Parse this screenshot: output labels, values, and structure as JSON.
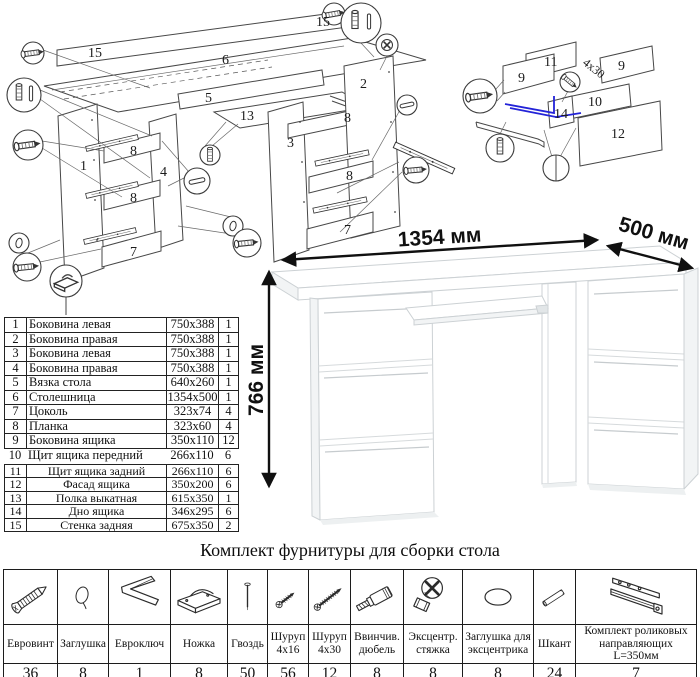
{
  "colors": {
    "accent_blue": "#2323d8",
    "diagram_line": "#474747",
    "desk_edge": "#ccd1d4"
  },
  "main_diagram": {
    "part_labels": [
      "15",
      "6",
      "15",
      "1",
      "8",
      "4",
      "8",
      "7",
      "5",
      "13",
      "3",
      "2",
      "8",
      "8",
      "7"
    ]
  },
  "drawer_diagram": {
    "part_labels": [
      "9",
      "11",
      "4x30",
      "9",
      "10",
      "14",
      "12"
    ]
  },
  "desk": {
    "width": "1354 мм",
    "depth": "500 мм",
    "height": "766 мм"
  },
  "parts": {
    "rows": [
      {
        "num": "1",
        "name": "Боковина левая",
        "size": "750x388",
        "qty": "1"
      },
      {
        "num": "2",
        "name": "Боковина правая",
        "size": "750x388",
        "qty": "1"
      },
      {
        "num": "3",
        "name": "Боковина левая",
        "size": "750x388",
        "qty": "1"
      },
      {
        "num": "4",
        "name": "Боковина правая",
        "size": "750x388",
        "qty": "1"
      },
      {
        "num": "5",
        "name": "Вязка стола",
        "size": "640x260",
        "qty": "1"
      },
      {
        "num": "6",
        "name": "Столешница",
        "size": "1354x500",
        "qty": "1"
      },
      {
        "num": "7",
        "name": "Цоколь",
        "size": "323x74",
        "qty": "4"
      },
      {
        "num": "8",
        "name": "Планка",
        "size": "323x60",
        "qty": "4"
      },
      {
        "num": "9",
        "name": "Боковина ящика",
        "size": "350x110",
        "qty": "12"
      },
      {
        "num": "10",
        "name": "Щит ящика передний",
        "size": "266x110",
        "qty": "6"
      },
      {
        "num": "11",
        "name": "Щит ящика задний",
        "size": "266x110",
        "qty": "6"
      },
      {
        "num": "12",
        "name": "Фасад ящика",
        "size": "350x200",
        "qty": "6"
      },
      {
        "num": "13",
        "name": "Полка выкатная",
        "size": "615x350",
        "qty": "1"
      },
      {
        "num": "14",
        "name": "Дно ящика",
        "size": "346x295",
        "qty": "6"
      },
      {
        "num": "15",
        "name": "Стенка задняя",
        "size": "675x350",
        "qty": "2"
      }
    ]
  },
  "hardware": {
    "title": "Комплект фурнитуры для сборки стола",
    "items": [
      {
        "name": "Евровинт",
        "qty": "36",
        "icon": "confirmat-screw"
      },
      {
        "name": "Заглушка",
        "qty": "8",
        "icon": "cap"
      },
      {
        "name": "Евроключ",
        "qty": "1",
        "icon": "hex-key"
      },
      {
        "name": "Ножка",
        "qty": "8",
        "icon": "foot"
      },
      {
        "name": "Гвоздь",
        "qty": "50",
        "icon": "nail"
      },
      {
        "name": "Шуруп 4x16",
        "qty": "56",
        "icon": "screw-short"
      },
      {
        "name": "Шуруп 4x30",
        "qty": "12",
        "icon": "screw-long"
      },
      {
        "name": "Ввинчив. дюбель",
        "qty": "8",
        "icon": "screw-in-dowel"
      },
      {
        "name": "Эксцентр. стяжка",
        "qty": "8",
        "icon": "cam-lock"
      },
      {
        "name": "Заглушка для эксцентрика",
        "qty": "8",
        "icon": "cam-cap"
      },
      {
        "name": "Шкант",
        "qty": "24",
        "icon": "wood-dowel"
      },
      {
        "name": "Комплект роликовых направляющих L=350мм",
        "qty": "7",
        "icon": "roller-slides"
      }
    ]
  }
}
